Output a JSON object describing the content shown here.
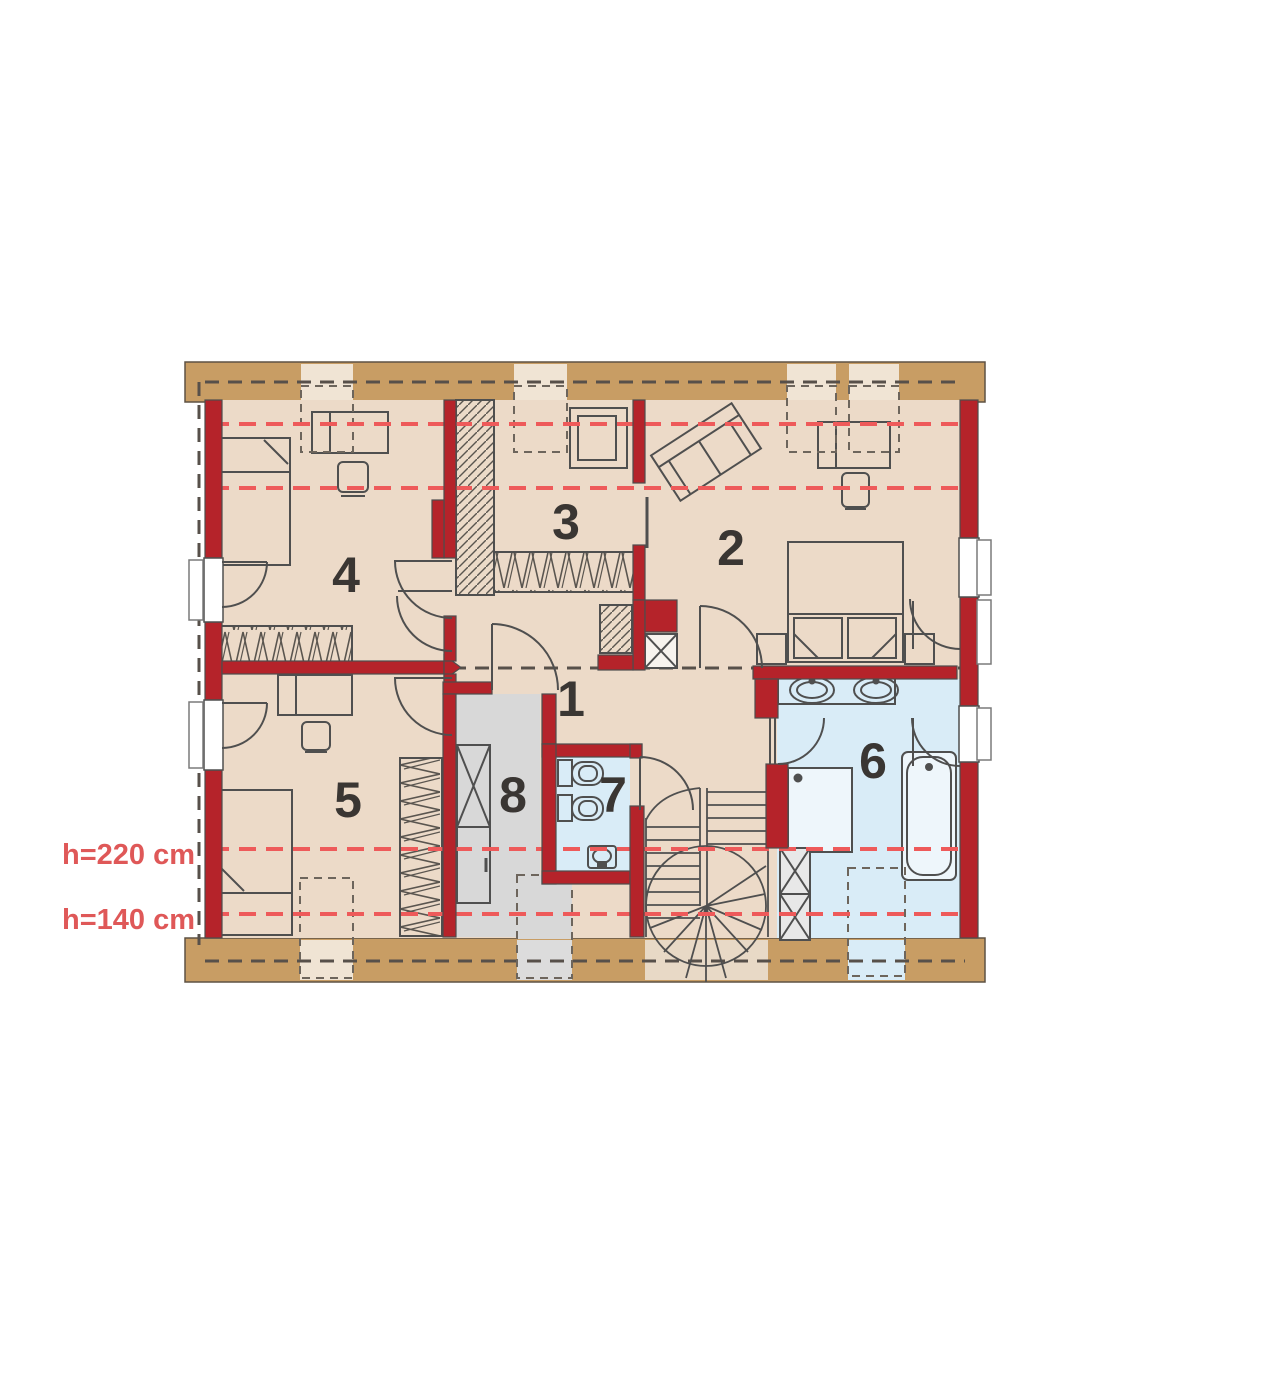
{
  "plan": {
    "title": "attic floor plan",
    "height_labels": [
      {
        "text": "h=220 cm"
      },
      {
        "text": "h=140 cm"
      }
    ],
    "rooms": [
      {
        "number": "1"
      },
      {
        "number": "2"
      },
      {
        "number": "3"
      },
      {
        "number": "4"
      },
      {
        "number": "5"
      },
      {
        "number": "6"
      },
      {
        "number": "7"
      },
      {
        "number": "8"
      }
    ],
    "colors": {
      "wall_red": "#b5232a",
      "wood_band": "#c89d64",
      "floor_beige": "#ecdac8",
      "floor_blue": "#d9ecf7",
      "floor_gray": "#d8d8d8",
      "dash_red": "#ee5a5a",
      "label_red": "#df5858",
      "line_gray": "#4f4f4f"
    }
  }
}
